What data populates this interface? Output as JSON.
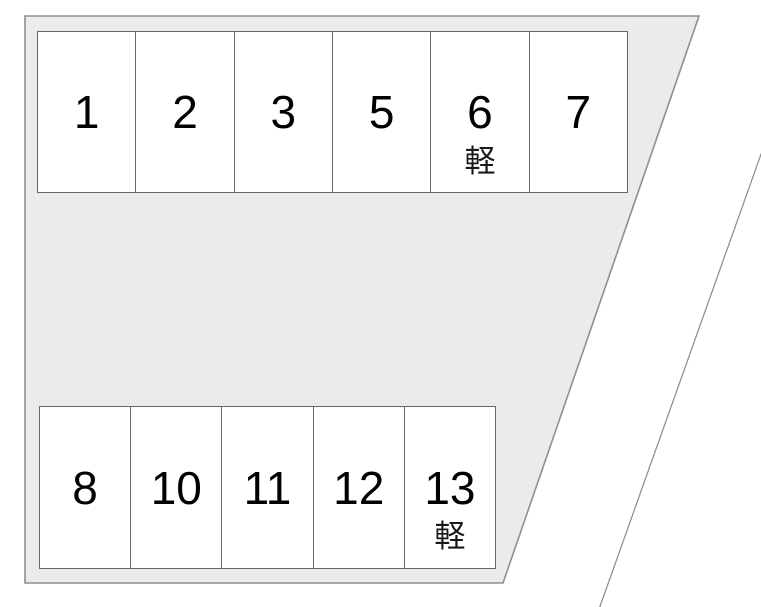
{
  "colors": {
    "background": "#ffffff",
    "lot_fill": "#ebebeb",
    "lot_border": "#8f8f8f",
    "space_fill": "#ffffff",
    "space_border": "#666666",
    "text": "#000000"
  },
  "lot": {
    "kei_note": "軽",
    "rows": [
      {
        "name": "top",
        "spaces": [
          {
            "number": "1",
            "note": ""
          },
          {
            "number": "2",
            "note": ""
          },
          {
            "number": "3",
            "note": ""
          },
          {
            "number": "5",
            "note": ""
          },
          {
            "number": "6",
            "note": "軽"
          },
          {
            "number": "7",
            "note": ""
          }
        ]
      },
      {
        "name": "bottom",
        "spaces": [
          {
            "number": "8",
            "note": ""
          },
          {
            "number": "10",
            "note": ""
          },
          {
            "number": "11",
            "note": ""
          },
          {
            "number": "12",
            "note": ""
          },
          {
            "number": "13",
            "note": "軽"
          }
        ]
      }
    ]
  }
}
